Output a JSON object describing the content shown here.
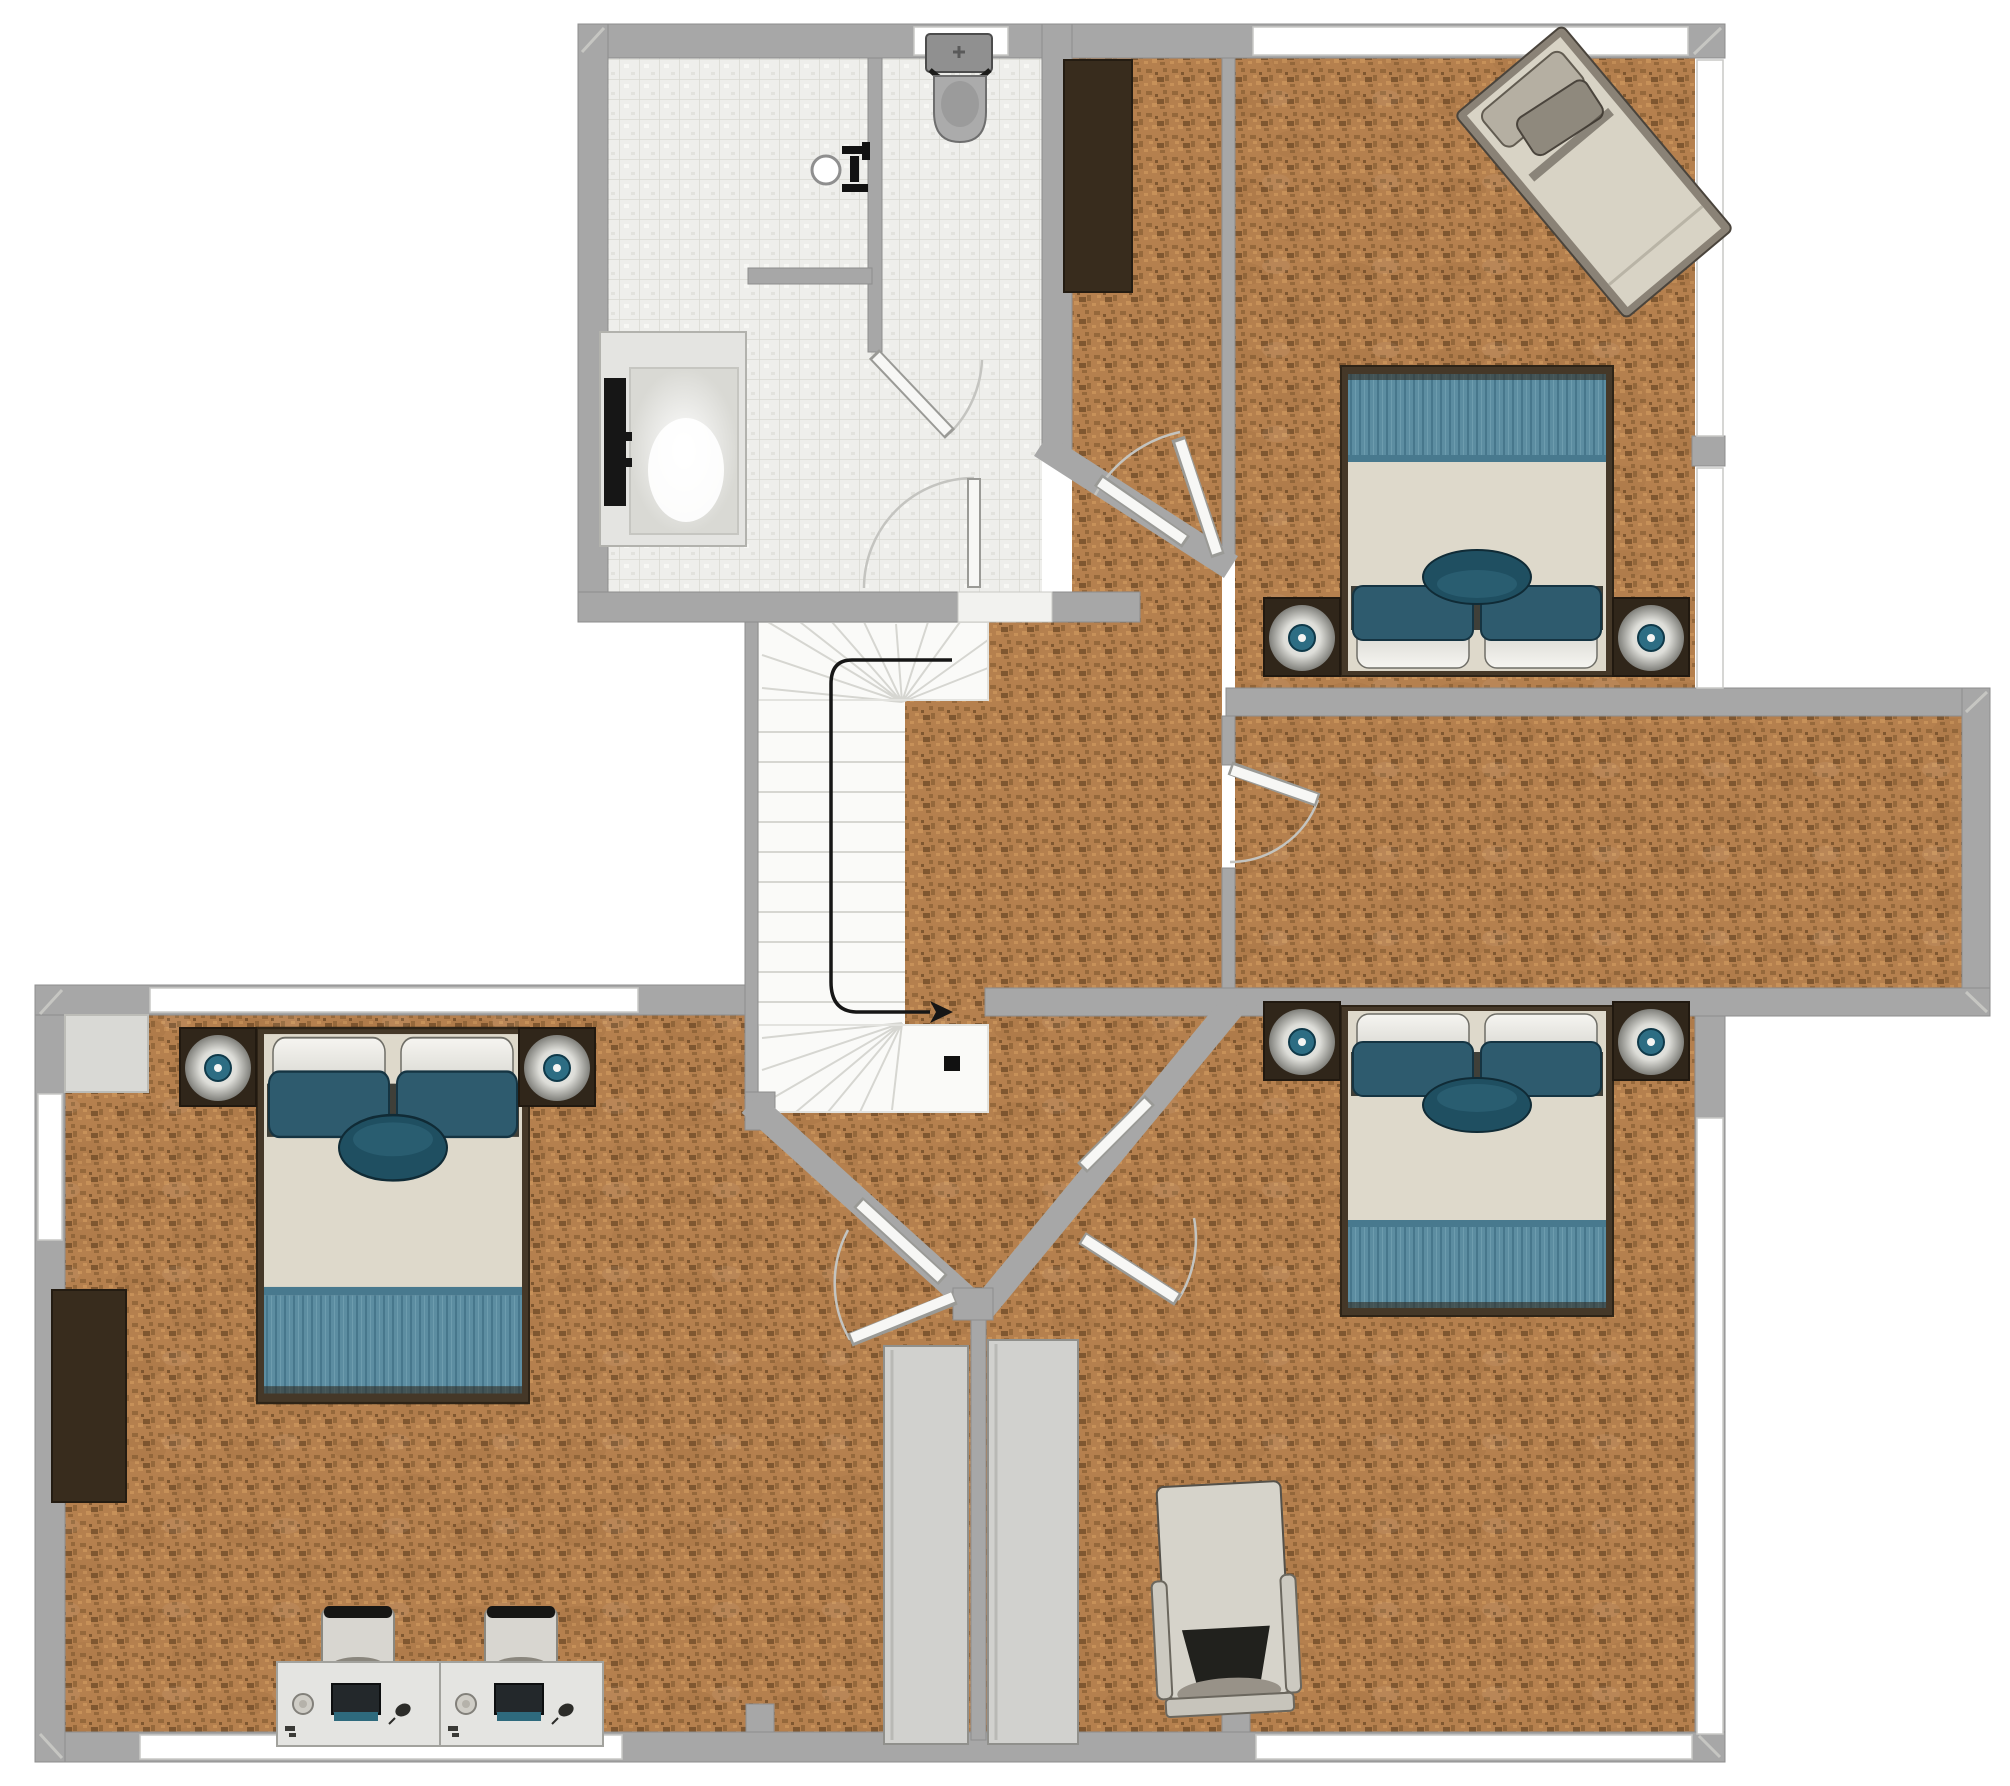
{
  "meta": {
    "view": "2d-floor-plan-top-view",
    "floor": "upper-floor",
    "canvas_px": {
      "width": 2010,
      "height": 1786
    },
    "visible_text": "none"
  },
  "colors": {
    "wall": "#a7a7a7",
    "wallEdge": "#8d8d8d",
    "wallLight": "#c6c6c2",
    "wood": "#b5804e",
    "woodDark": "#95683b",
    "woodDarker": "#7f5730",
    "woodLight": "#c79159",
    "tile": "#eeeeeb",
    "tileLine": "#d8d8d2",
    "stair": "#fafaf8",
    "tread": "#d6d6d1",
    "mattress": "#ded9cb",
    "blanket": "#5c8da1",
    "blanketLine": "#47778c",
    "pillowTeal": "#2e5b6e",
    "bolster": "#1f4f61",
    "bedFrame": "#453828",
    "nightstand": "#30261a",
    "lampTeal": "#2d6d83",
    "darkWardrobe": "#382c1d",
    "panel": "#d1d1ce",
    "desk": "#e4e4e1",
    "chair": "#d8d6d0",
    "armchair": "#d6d3ca",
    "arrow": "#161616",
    "doorWhite": "#f7f7f5",
    "arc": "#c4c4c0",
    "exterior": "#ffffff"
  },
  "rooms": [
    {
      "id": "bathroom",
      "name": "Bathroom",
      "floor": "white-mosaic-tile",
      "fixtures": [
        "shower-tub",
        "wall-sink",
        "half-wall"
      ]
    },
    {
      "id": "wc",
      "name": "WC nook",
      "floor": "white-mosaic-tile",
      "fixtures": [
        "toilet"
      ]
    },
    {
      "id": "bedroom-top-right",
      "name": "Bedroom (top right)",
      "floor": "cork-wood",
      "furniture": [
        "double-bed",
        "2 nightstand-lamps",
        "single-daybed-angled",
        "closet-strip-with-wardrobe"
      ]
    },
    {
      "id": "corridor-room",
      "name": "Long side room / walk-in corridor",
      "floor": "cork-wood",
      "furniture": []
    },
    {
      "id": "landing-hall",
      "name": "Landing / hall",
      "floor": "cork-wood",
      "furniture": [
        "dark-wardrobe"
      ]
    },
    {
      "id": "staircase",
      "name": "Winding staircase",
      "floor": "white-treads",
      "annotations": [
        "direction-arrow",
        "black-marker-square"
      ]
    },
    {
      "id": "bedroom-bottom-left",
      "name": "Bedroom (bottom left)",
      "floor": "cork-wood",
      "furniture": [
        "double-bed",
        "2 nightstand-lamps",
        "dark-wardrobe",
        "corner-closet-box",
        "2 desks-with-chairs"
      ]
    },
    {
      "id": "bedroom-bottom-right",
      "name": "Bedroom (bottom right)",
      "floor": "cork-wood",
      "furniture": [
        "double-bed",
        "2 nightstand-lamps",
        "armchair"
      ]
    }
  ],
  "furniture_counts": {
    "double_beds": 3,
    "single_beds": 1,
    "nightstands_with_lamps": 6,
    "desks": 2,
    "desk_chairs": 2,
    "armchairs": 1,
    "wardrobes_dark": 2,
    "closet_panels_gray": 2,
    "toilets": 1,
    "sinks": 1,
    "showers": 1
  },
  "doors": [
    {
      "id": "bathroom-door",
      "swings_into": "bathroom"
    },
    {
      "id": "wc-door",
      "swings_into": "wc"
    },
    {
      "id": "bedroom-top-right-door",
      "on": "diagonal-wall-upper"
    },
    {
      "id": "corridor-room-door",
      "on": "corridor-left-wall"
    },
    {
      "id": "bedroom-bottom-left-door",
      "on": "diagonal-wall-left"
    },
    {
      "id": "bedroom-bottom-right-door",
      "on": "diagonal-wall-right"
    }
  ],
  "windows": [
    {
      "id": "win-top-toilet"
    },
    {
      "id": "win-top-bedroom-long"
    },
    {
      "id": "win-right-upper-a"
    },
    {
      "id": "win-right-upper-b"
    },
    {
      "id": "win-right-lower"
    },
    {
      "id": "win-bottom-right"
    },
    {
      "id": "win-bottom-left"
    },
    {
      "id": "win-left"
    },
    {
      "id": "win-bl-top"
    }
  ],
  "stairs": {
    "shape": "U-winder",
    "arrow": "down-left-up path with arrowhead pointing right"
  }
}
